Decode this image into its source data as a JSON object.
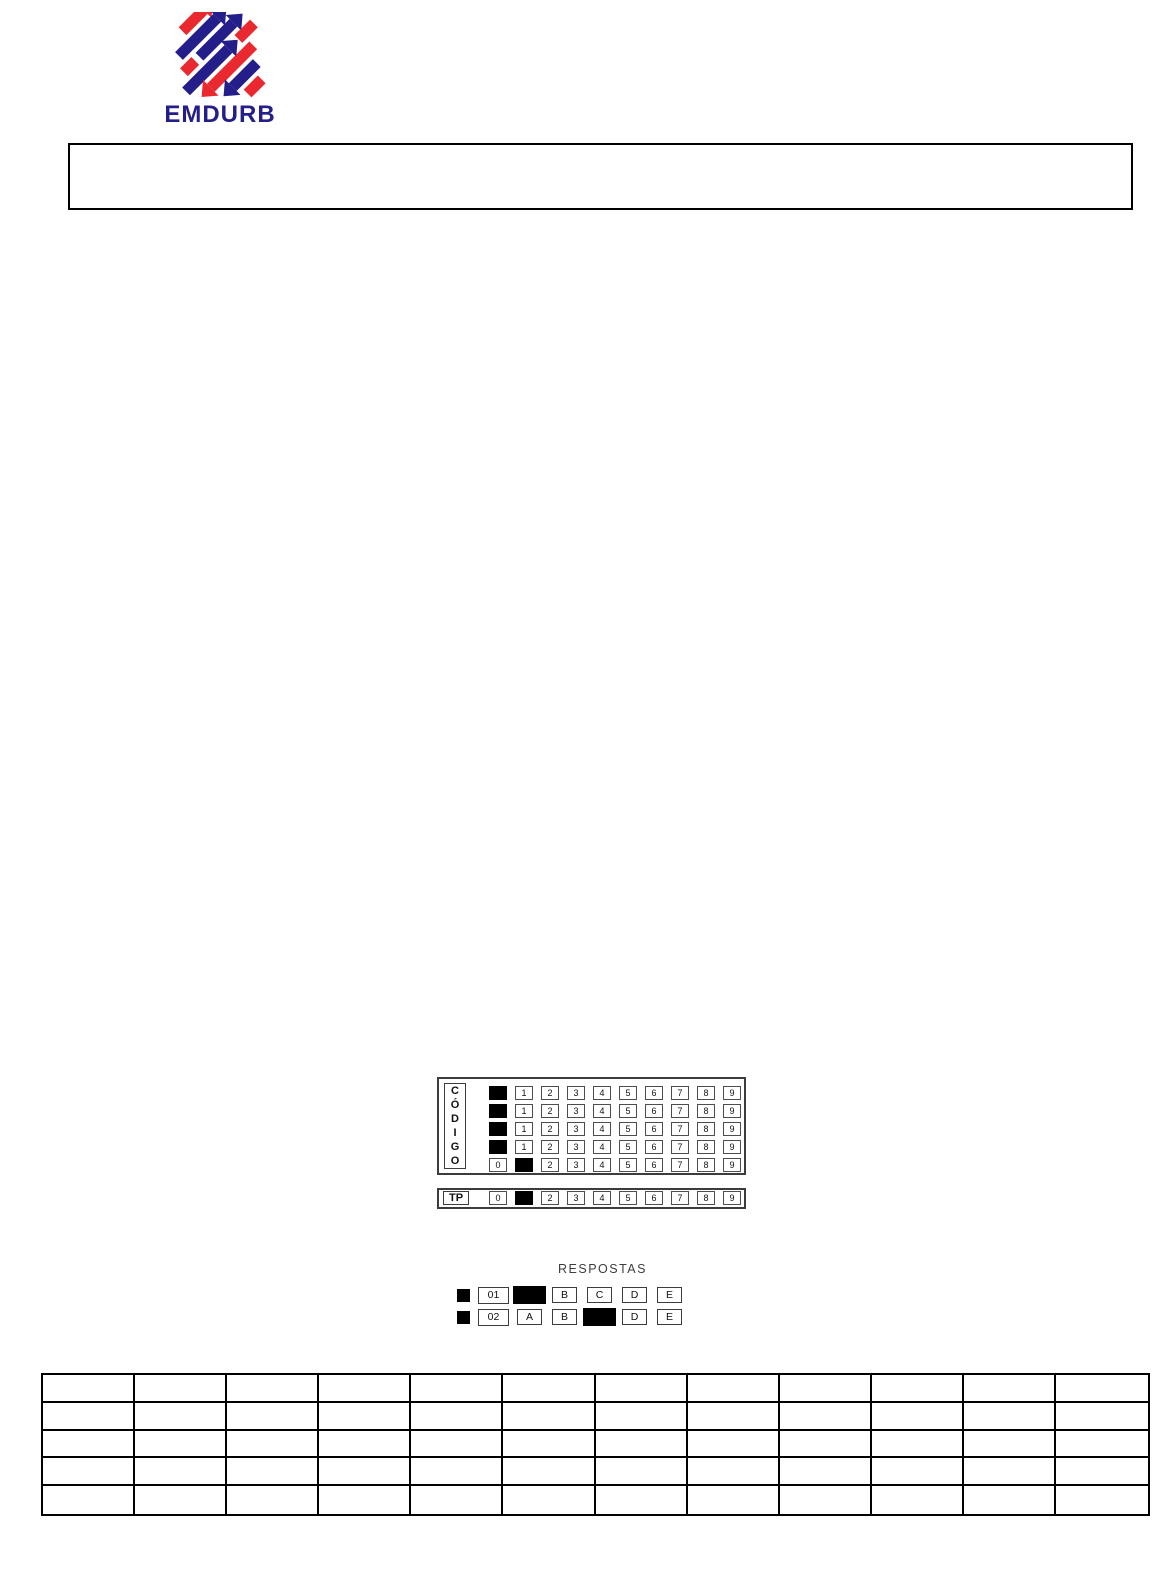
{
  "logo": {
    "text": "EMDURB",
    "red": "#E9292F",
    "blue": "#241E8B"
  },
  "codigo": {
    "label": "CÓDIGO",
    "label_letters": [
      "C",
      "Ó",
      "D",
      "I",
      "G",
      "O"
    ],
    "rows": [
      {
        "filled_index": 0,
        "values": [
          "",
          "1",
          "2",
          "3",
          "4",
          "5",
          "6",
          "7",
          "8",
          "9"
        ]
      },
      {
        "filled_index": 0,
        "values": [
          "",
          "1",
          "2",
          "3",
          "4",
          "5",
          "6",
          "7",
          "8",
          "9"
        ]
      },
      {
        "filled_index": 0,
        "values": [
          "",
          "1",
          "2",
          "3",
          "4",
          "5",
          "6",
          "7",
          "8",
          "9"
        ]
      },
      {
        "filled_index": 0,
        "values": [
          "",
          "1",
          "2",
          "3",
          "4",
          "5",
          "6",
          "7",
          "8",
          "9"
        ]
      },
      {
        "filled_index": 1,
        "values": [
          "0",
          "",
          "2",
          "3",
          "4",
          "5",
          "6",
          "7",
          "8",
          "9"
        ]
      }
    ]
  },
  "tp": {
    "label": "TP",
    "filled_index": 1,
    "values": [
      "0",
      "",
      "2",
      "3",
      "4",
      "5",
      "6",
      "7",
      "8",
      "9"
    ]
  },
  "respostas": {
    "title": "RESPOSTAS",
    "rows": [
      {
        "number": "01",
        "filled_index": 0,
        "options": [
          "",
          "B",
          "C",
          "D",
          "E"
        ]
      },
      {
        "number": "02",
        "filled_index": 2,
        "options": [
          "A",
          "B",
          "",
          "D",
          "E"
        ]
      }
    ]
  },
  "answer_table": {
    "rows": 5,
    "cols": 12
  }
}
